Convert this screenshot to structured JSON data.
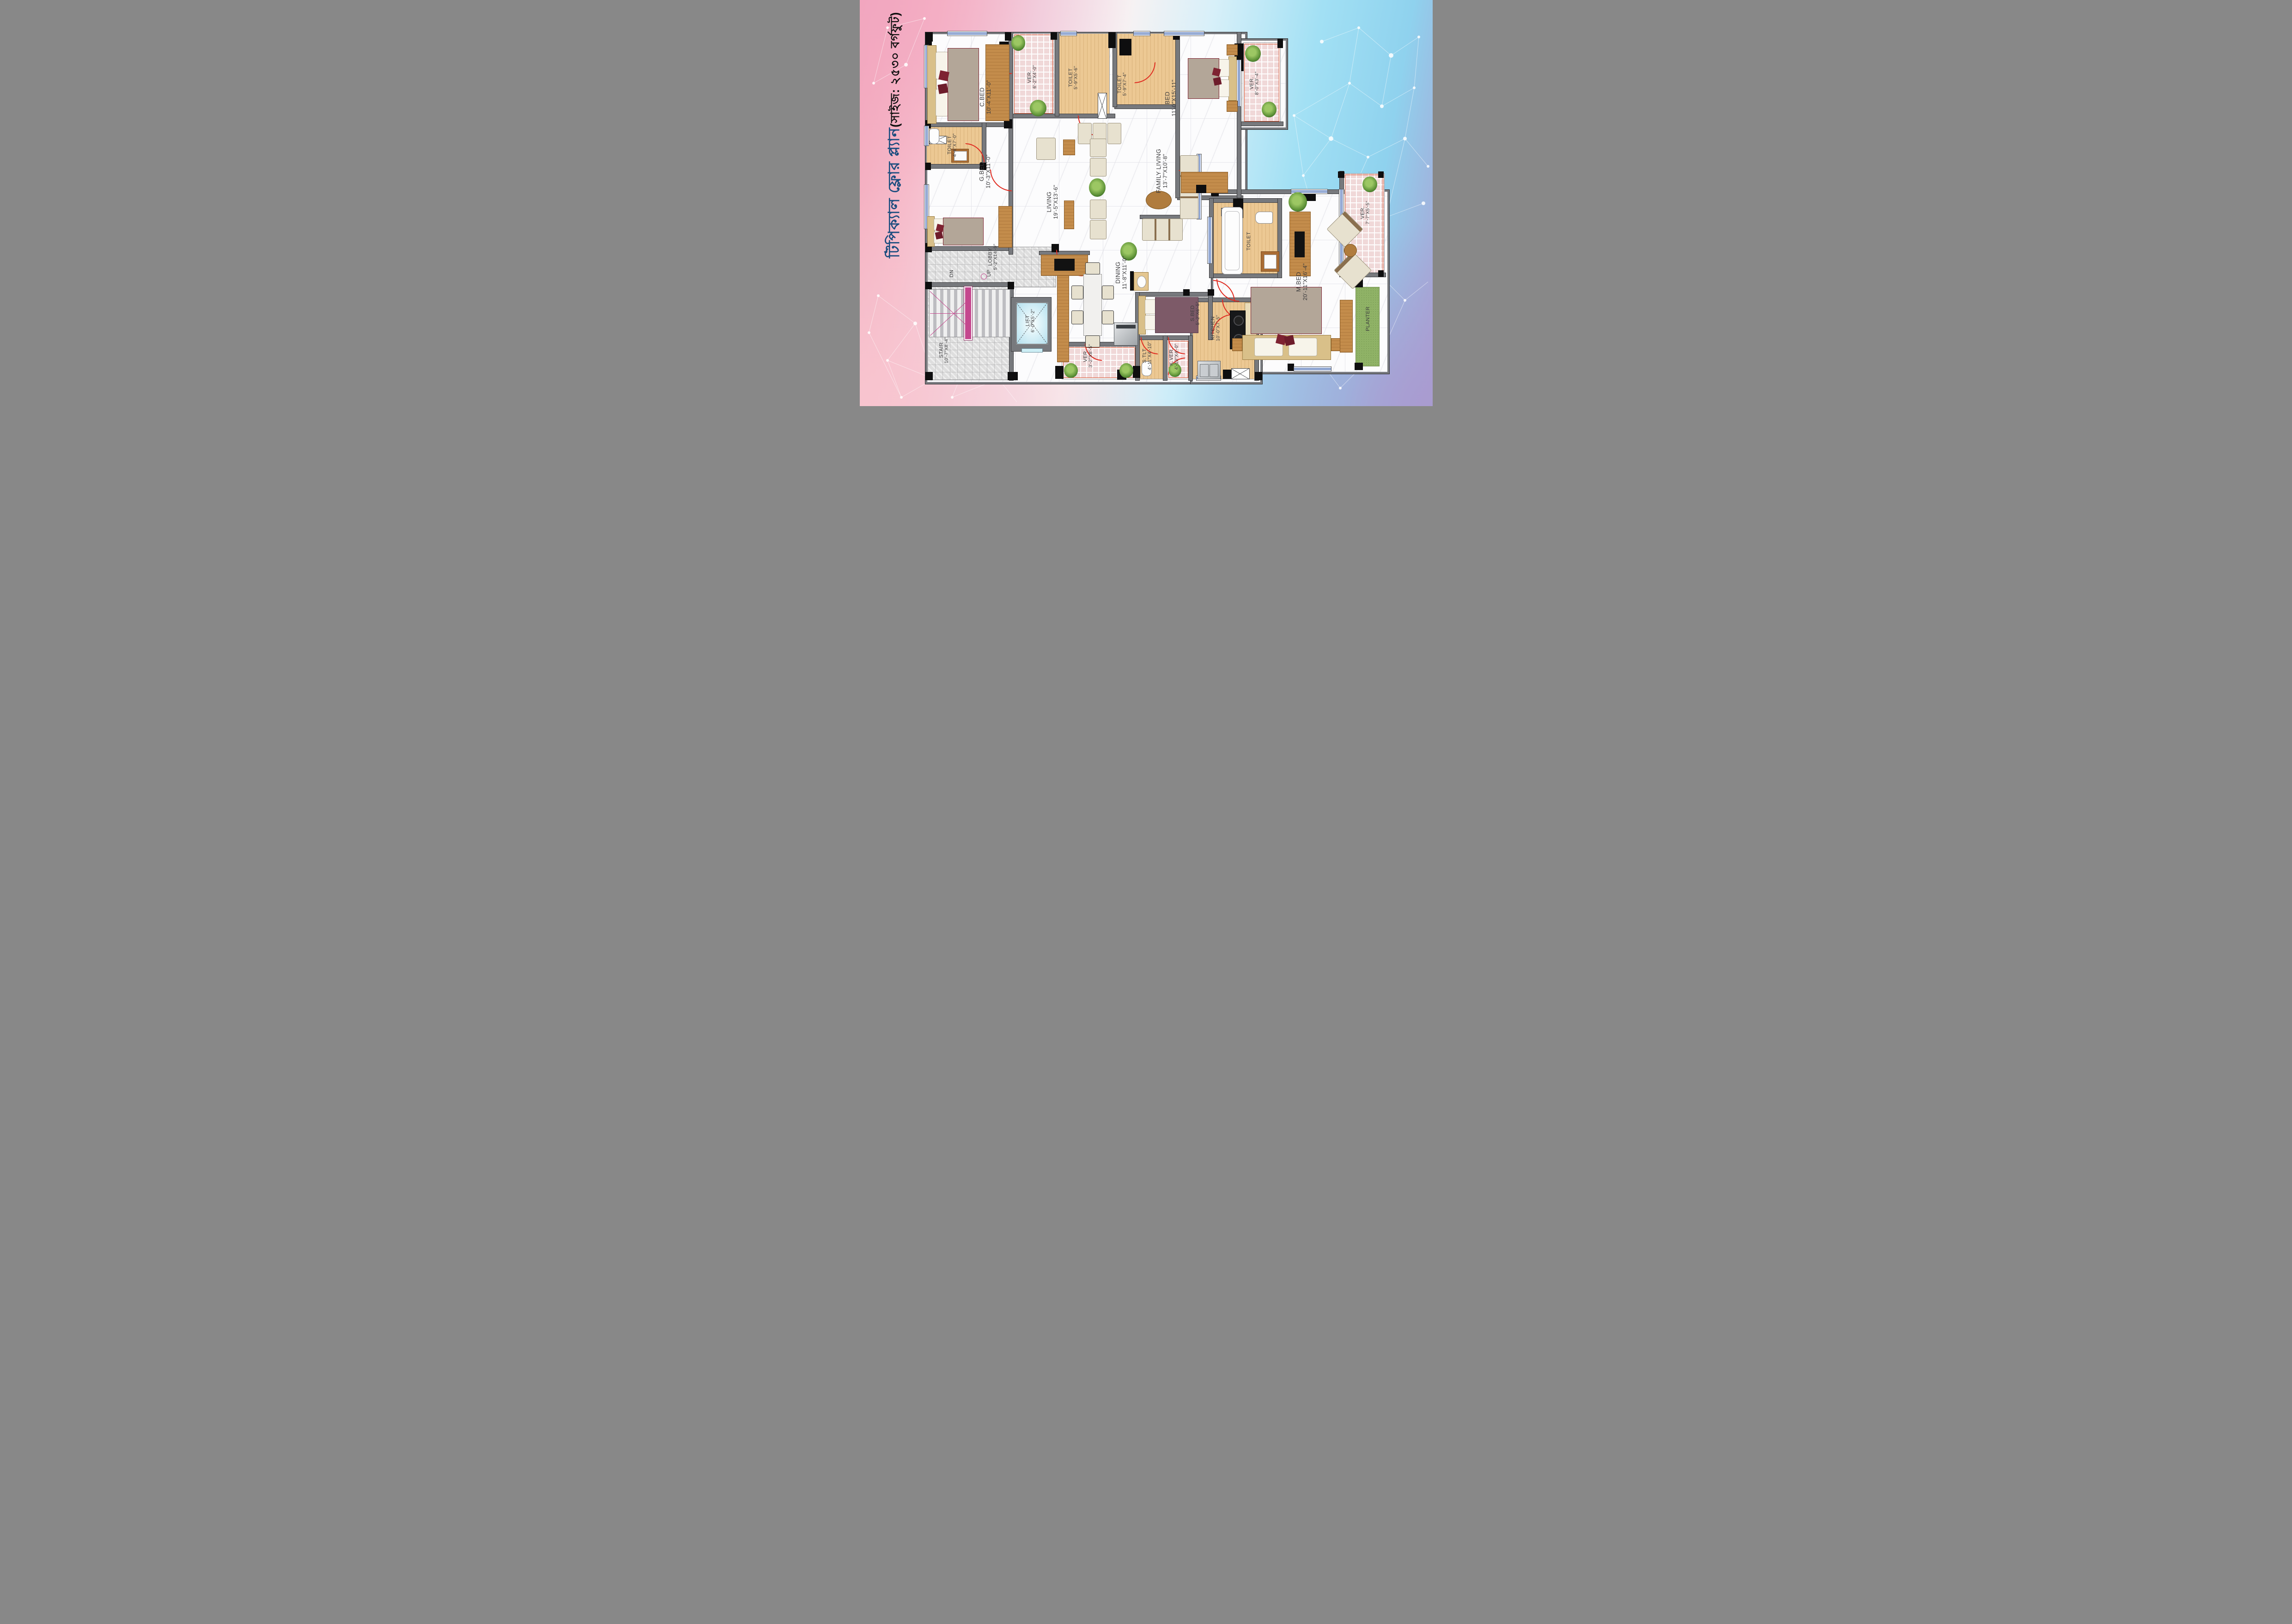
{
  "title": {
    "main": "টিপিক্যাল ফ্লোর প্ল্যান",
    "size": "(সাইজ: ২৫৩০ বর্গফুট)"
  },
  "rooms": {
    "cbed": {
      "name": "C.BED",
      "dims": "10'-4\"X11'-0\""
    },
    "ver_top": {
      "name": "VER.",
      "dims": "6'-2\"X4'-0\""
    },
    "toilet_a": {
      "name": "TOILET",
      "dims": "5'-9\"X5'-6\""
    },
    "toilet_b": {
      "name": "TOILET",
      "dims": "5'-9\"X7'-4\""
    },
    "bed": {
      "name": "BED",
      "dims": "11'-0\"X15'-11\""
    },
    "ver_right_top": {
      "name": "VER.",
      "dims": "8'-0\"X3'-4\""
    },
    "toilet_c": {
      "name": "TOILET",
      "dims": "4'-6\"X7'-0\""
    },
    "gbed": {
      "name": "G.BED",
      "dims": "10'-3\"X11'-0\""
    },
    "living": {
      "name": "LIVING",
      "dims": "19'-5\"X13'-6\""
    },
    "family": {
      "name": "FAMILY LIVING",
      "dims": "13'-7\"X10'-8\""
    },
    "toilet_m": {
      "name": "TOILET"
    },
    "ver_right": {
      "name": "VER.",
      "dims": "7'-7\"X5'-5\""
    },
    "mbed": {
      "name": "M.BED",
      "dims": "20'-11\"X16'-4\""
    },
    "lobby": {
      "name": "LOBBY",
      "dims": "5'-2\"X14'-9\""
    },
    "up": "UP",
    "dn": "DN",
    "stair": {
      "name": "STAIR",
      "dims": "10'-7\"X8'-4\""
    },
    "lift": {
      "name": "LIFT",
      "dims": "6'-0\"X5'-2\""
    },
    "dining": {
      "name": "DINING",
      "dims": "11'-8\"X11'-0\""
    },
    "sbed": {
      "name": "S.BED",
      "dims": "5'-2\"X6'-5\""
    },
    "kitchen": {
      "name": "KITCHEN",
      "dims": "10'-0\"X7'-5\""
    },
    "stlt": {
      "name": "S.TLT",
      "dims": "4'-11\"X4'-10\""
    },
    "kver": {
      "name": "K.VER.",
      "dims": "4'-10\"X4'-0\""
    },
    "ver_bottom": {
      "name": "VER.",
      "dims": "3'-2\"X8'-5\""
    },
    "planter": {
      "name": "PLANTER"
    }
  },
  "colors": {
    "accent_wall": "#77797d",
    "door_red": "#e02b20",
    "window_blue": "#2b55a8",
    "verandah_pink": "#f0d8d8",
    "lift_cyan": "#bfe4ef",
    "planter_green": "#8fb266",
    "title_blue": "#1c4d7f"
  }
}
